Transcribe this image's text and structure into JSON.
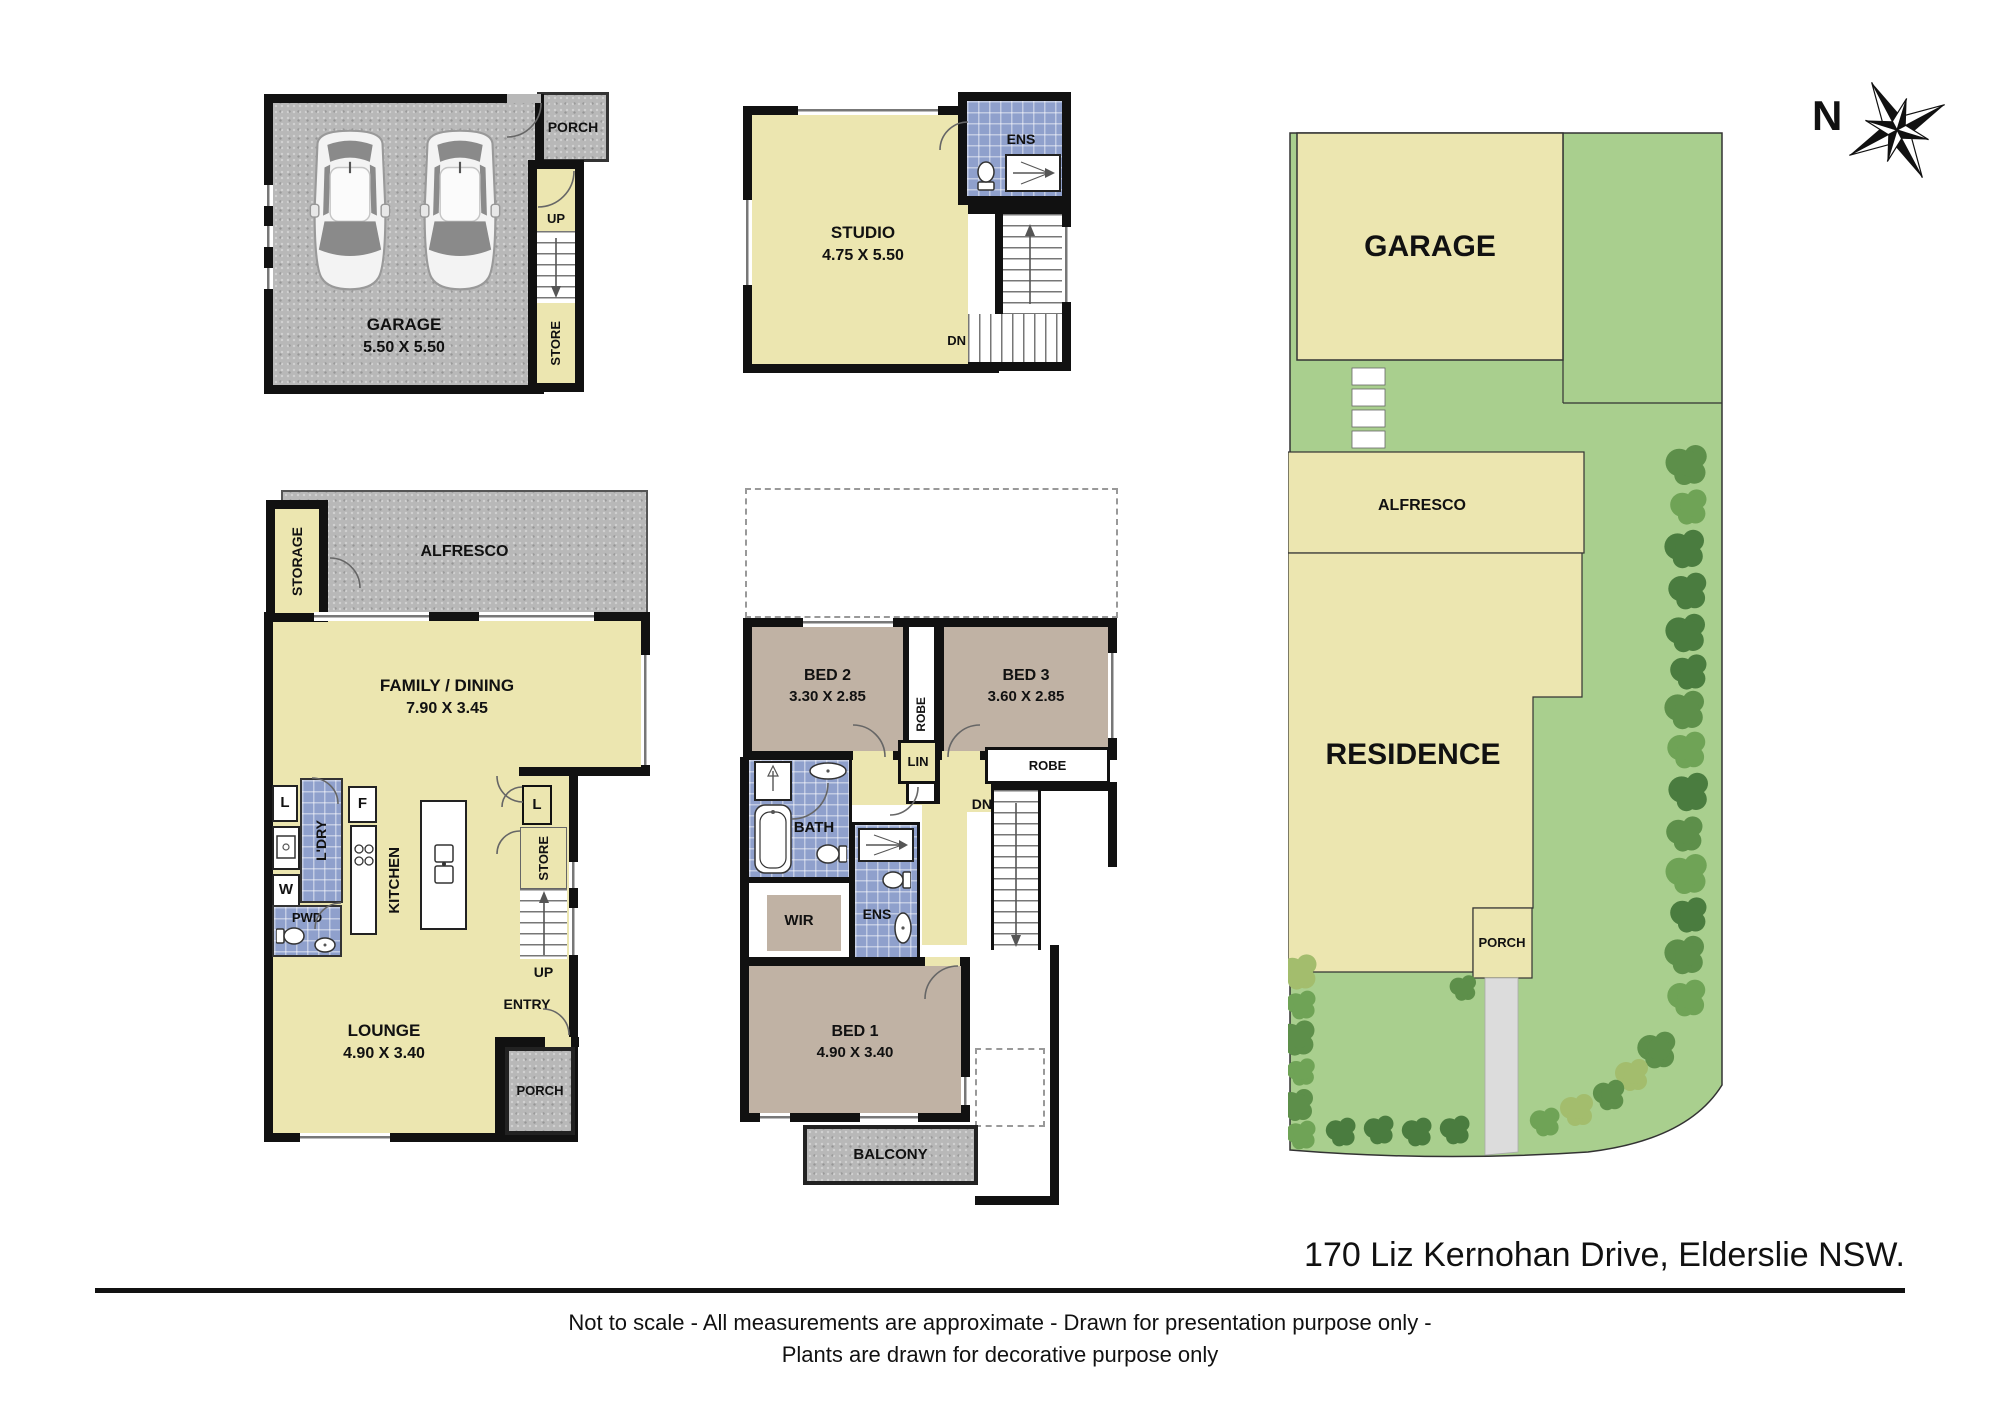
{
  "compass": {
    "north": "N"
  },
  "garage_plan": {
    "porch": "PORCH",
    "up": "UP",
    "store": "STORE",
    "name": "GARAGE",
    "dims": "5.50 X 5.50"
  },
  "studio_plan": {
    "name": "STUDIO",
    "dims": "4.75 X 5.50",
    "ens": "ENS",
    "dn": "DN"
  },
  "ground_plan": {
    "storage": "STORAGE",
    "alfresco": "ALFRESCO",
    "family": "FAMILY / DINING",
    "family_dims": "7.90 X 3.45",
    "linen_cupboard": "L",
    "laundry": "L'DRY",
    "washer": "W",
    "fridge": "F",
    "kitchen": "KITCHEN",
    "powder": "PWD",
    "linen_closet": "L",
    "store": "STORE",
    "up": "UP",
    "entry": "ENTRY",
    "lounge": "LOUNGE",
    "lounge_dims": "4.90 X 3.40",
    "porch": "PORCH"
  },
  "upper_plan": {
    "bed2": "BED 2",
    "bed2_dims": "3.30 X 2.85",
    "robe_vertical": "ROBE",
    "bed3": "BED 3",
    "bed3_dims": "3.60 X 2.85",
    "linen": "LIN",
    "robe_bed3": "ROBE",
    "bath": "BATH",
    "dn": "DN",
    "wir": "WIR",
    "ens": "ENS",
    "bed1": "BED 1",
    "bed1_dims": "4.90 X 3.40",
    "balcony": "BALCONY"
  },
  "site_plan": {
    "garage": "GARAGE",
    "alfresco": "ALFRESCO",
    "residence": "RESIDENCE",
    "porch": "PORCH"
  },
  "footer": {
    "address": "170 Liz Kernohan Drive, Elderslie NSW.",
    "disclaimer_line1": "Not to scale - All measurements are approximate - Drawn for presentation purpose only -",
    "disclaimer_line2": "Plants are drawn for decorative purpose only"
  },
  "colors": {
    "wall": "#111111",
    "floor_yellow": "#ece6b0",
    "tile_blue": "#8fa0cc",
    "bedroom_taupe": "#c0b2a4",
    "concrete_gray": "#b8b8b8",
    "lawn_green": "#a9cf8e",
    "site_building_yellow": "#ece6b0",
    "driveway_gray": "#dcdcdc"
  }
}
